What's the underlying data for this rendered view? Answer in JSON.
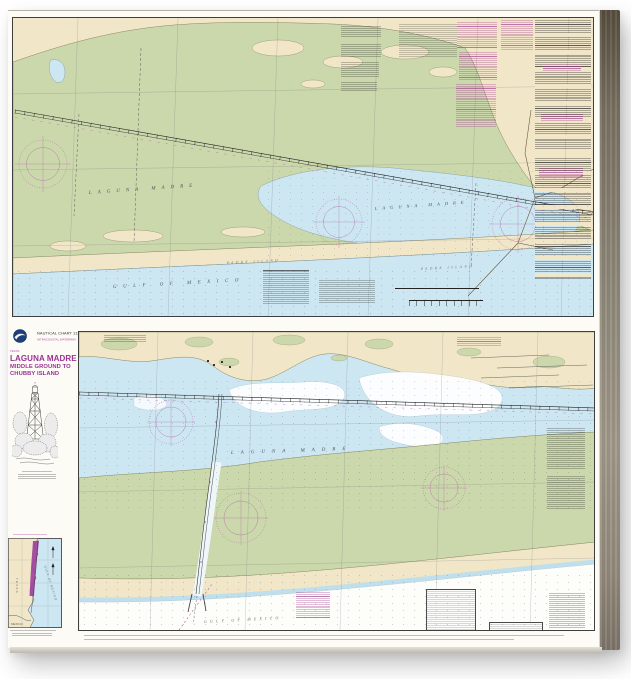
{
  "colors": {
    "land": "#f1e7c8",
    "marsh": "#cbd8ab",
    "water": "#cde7f2",
    "gulfwhite": "#fdfdfa",
    "magenta": "#b25aa8",
    "ink": "#333333"
  },
  "sidebar": {
    "agency_chart_label": "NAUTICAL CHART 11306",
    "waterway_label": "INTRACOASTAL WATERWAY",
    "state_label": "TEXAS",
    "title1": "LAGUNA MADRE",
    "title2": "MIDDLE GROUND TO",
    "title3": "CHUBBY ISLAND"
  },
  "top_chart": {
    "label_laguna_flats": "LAGUNA MADRE",
    "label_laguna_bay": "LAGUNA MADRE",
    "label_padre_west": "PADRE ISLAND",
    "label_padre_east": "PADRE ISLAND",
    "label_gulf": "GULF OF MEXICO"
  },
  "bottom_chart": {
    "label_laguna": "LAGUNA MADRE",
    "label_gulf": "GULF OF MEXICO"
  },
  "inset": {
    "label_state": "TEXAS",
    "label_gulf": "GULF OF MEXICO",
    "label_mexico": "MEXICO"
  }
}
